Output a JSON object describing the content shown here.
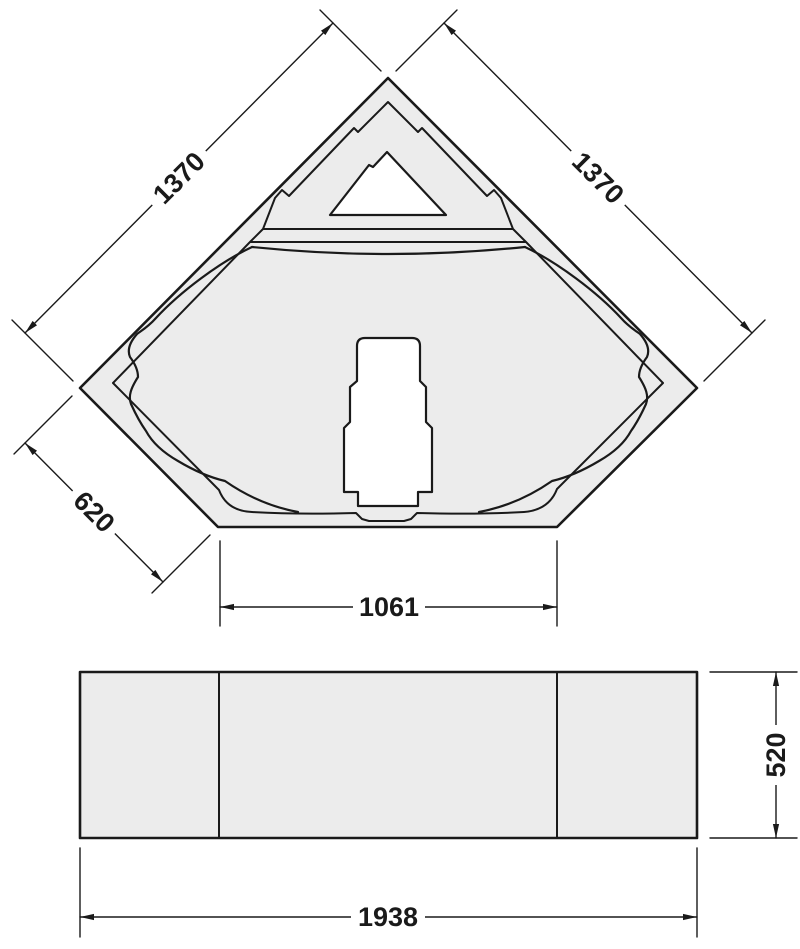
{
  "colors": {
    "line": "#1a1a1a",
    "fill": "#ececec",
    "background": "#ffffff"
  },
  "top_view": {
    "dims": {
      "left_edge": "1370",
      "right_edge": "1370",
      "corner_edge": "620",
      "bottom_width": "1061"
    }
  },
  "front_view": {
    "dims": {
      "height": "520",
      "width": "1938"
    }
  }
}
